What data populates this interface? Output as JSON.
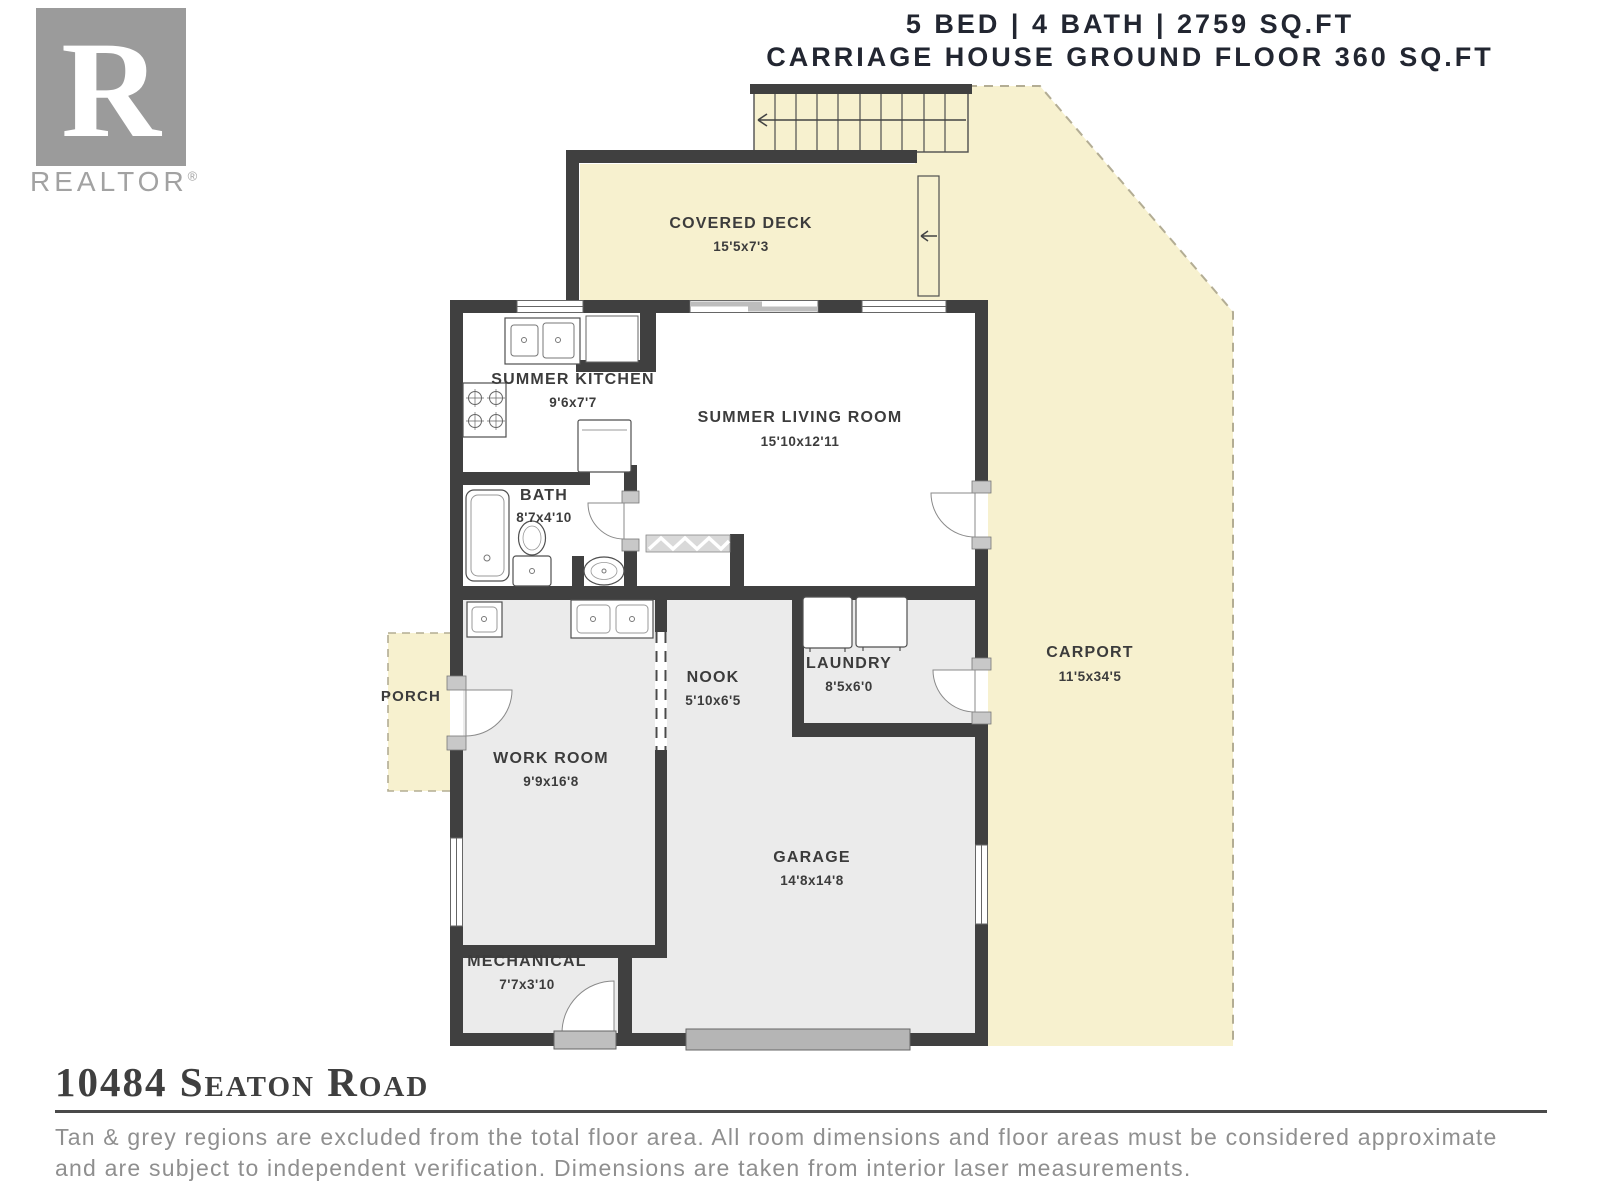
{
  "header": {
    "line1": "5 BED | 4 BATH | 2759 SQ.FT",
    "line2": "CARRIAGE HOUSE GROUND FLOOR 360 SQ.FT"
  },
  "logo": {
    "letter": "R",
    "wordmark": "REALTOR",
    "registered": "®"
  },
  "rooms": {
    "covered_deck": {
      "name": "COVERED DECK",
      "dims": "15'5x7'3"
    },
    "summer_kitchen": {
      "name": "SUMMER KITCHEN",
      "dims": "9'6x7'7"
    },
    "summer_living": {
      "name": "SUMMER LIVING ROOM",
      "dims": "15'10x12'11"
    },
    "bath": {
      "name": "BATH",
      "dims": "8'7x4'10"
    },
    "porch": {
      "name": "PORCH"
    },
    "work_room": {
      "name": "WORK ROOM",
      "dims": "9'9x16'8"
    },
    "nook": {
      "name": "NOOK",
      "dims": "5'10x6'5"
    },
    "laundry": {
      "name": "LAUNDRY",
      "dims": "8'5x6'0"
    },
    "garage": {
      "name": "GARAGE",
      "dims": "14'8x14'8"
    },
    "mechanical": {
      "name": "MECHANICAL",
      "dims": "7'7x3'10"
    },
    "carport": {
      "name": "CARPORT",
      "dims": "11'5x34'5"
    }
  },
  "footer": {
    "address": "10484 Seaton Road",
    "disclaimer_line1": "Tan & grey regions are excluded from the total floor area. All room dimensions and floor areas must be considered approximate",
    "disclaimer_line2": "and are subject to independent verification. Dimensions are taken from interior laser measurements."
  },
  "colors": {
    "outdoor_tan": "#f7f1cf",
    "wall": "#404040",
    "excluded_grey": "#ebebeb",
    "door_jamb_grey": "#c8c8c8",
    "garage_door_grey": "#b5b5b5",
    "label_text": "#3c3c3c",
    "header_text": "#222631",
    "logo_grey": "#9b9b9b",
    "disclaimer_grey": "#8f8f8f"
  }
}
